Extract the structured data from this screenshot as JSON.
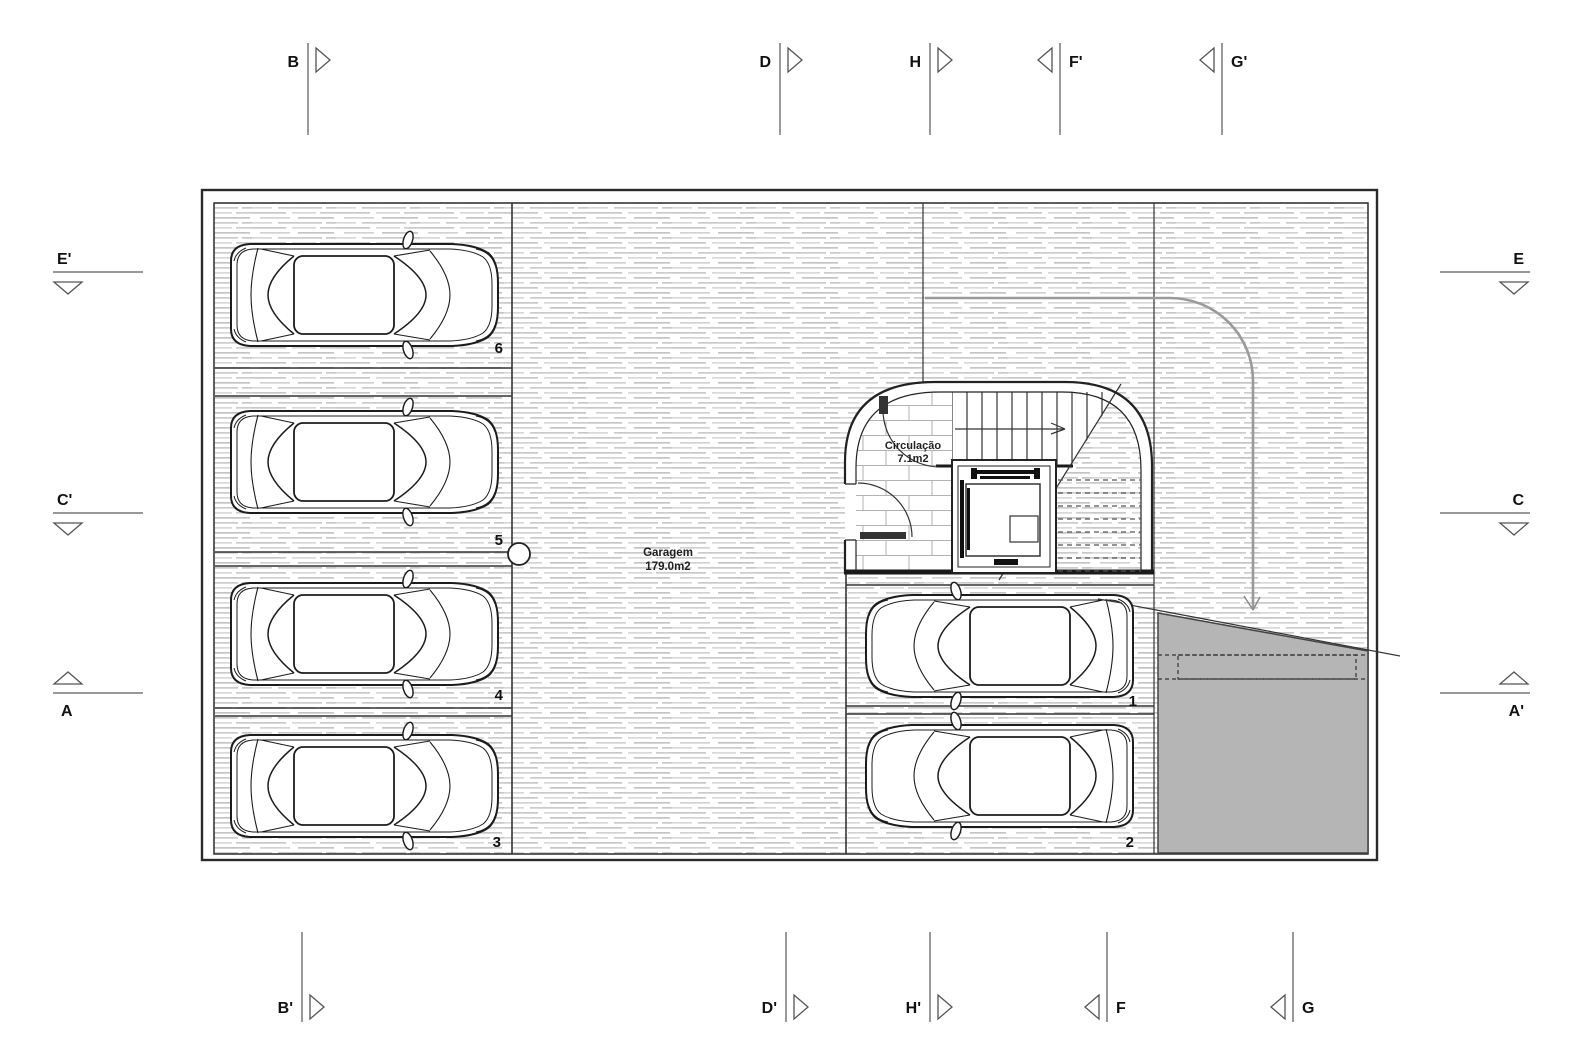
{
  "drawing_type": "garage-floor-plan",
  "rooms": {
    "garage": {
      "name": "Garagem",
      "area": "179.0m2"
    },
    "circulation": {
      "name": "Circulação",
      "area": "7.1m2"
    }
  },
  "parking": {
    "numbers": [
      "1",
      "2",
      "3",
      "4",
      "5",
      "6"
    ]
  },
  "markers": {
    "top": [
      {
        "label": "B"
      },
      {
        "label": "D"
      },
      {
        "label": "H"
      },
      {
        "label": "F'"
      },
      {
        "label": "G'"
      }
    ],
    "bottom": [
      {
        "label": "B'"
      },
      {
        "label": "D'"
      },
      {
        "label": "H'"
      },
      {
        "label": "F"
      },
      {
        "label": "G"
      }
    ],
    "left": [
      {
        "label": "E'"
      },
      {
        "label": "C'"
      },
      {
        "label": "A"
      }
    ],
    "right": [
      {
        "label": "E"
      },
      {
        "label": "C"
      },
      {
        "label": "A'"
      }
    ]
  },
  "colors": {
    "ramp_fill": "#b5b5b5",
    "turn_path": "#9a9a9a",
    "wall_line": "#222222",
    "section_line": "#777777"
  }
}
